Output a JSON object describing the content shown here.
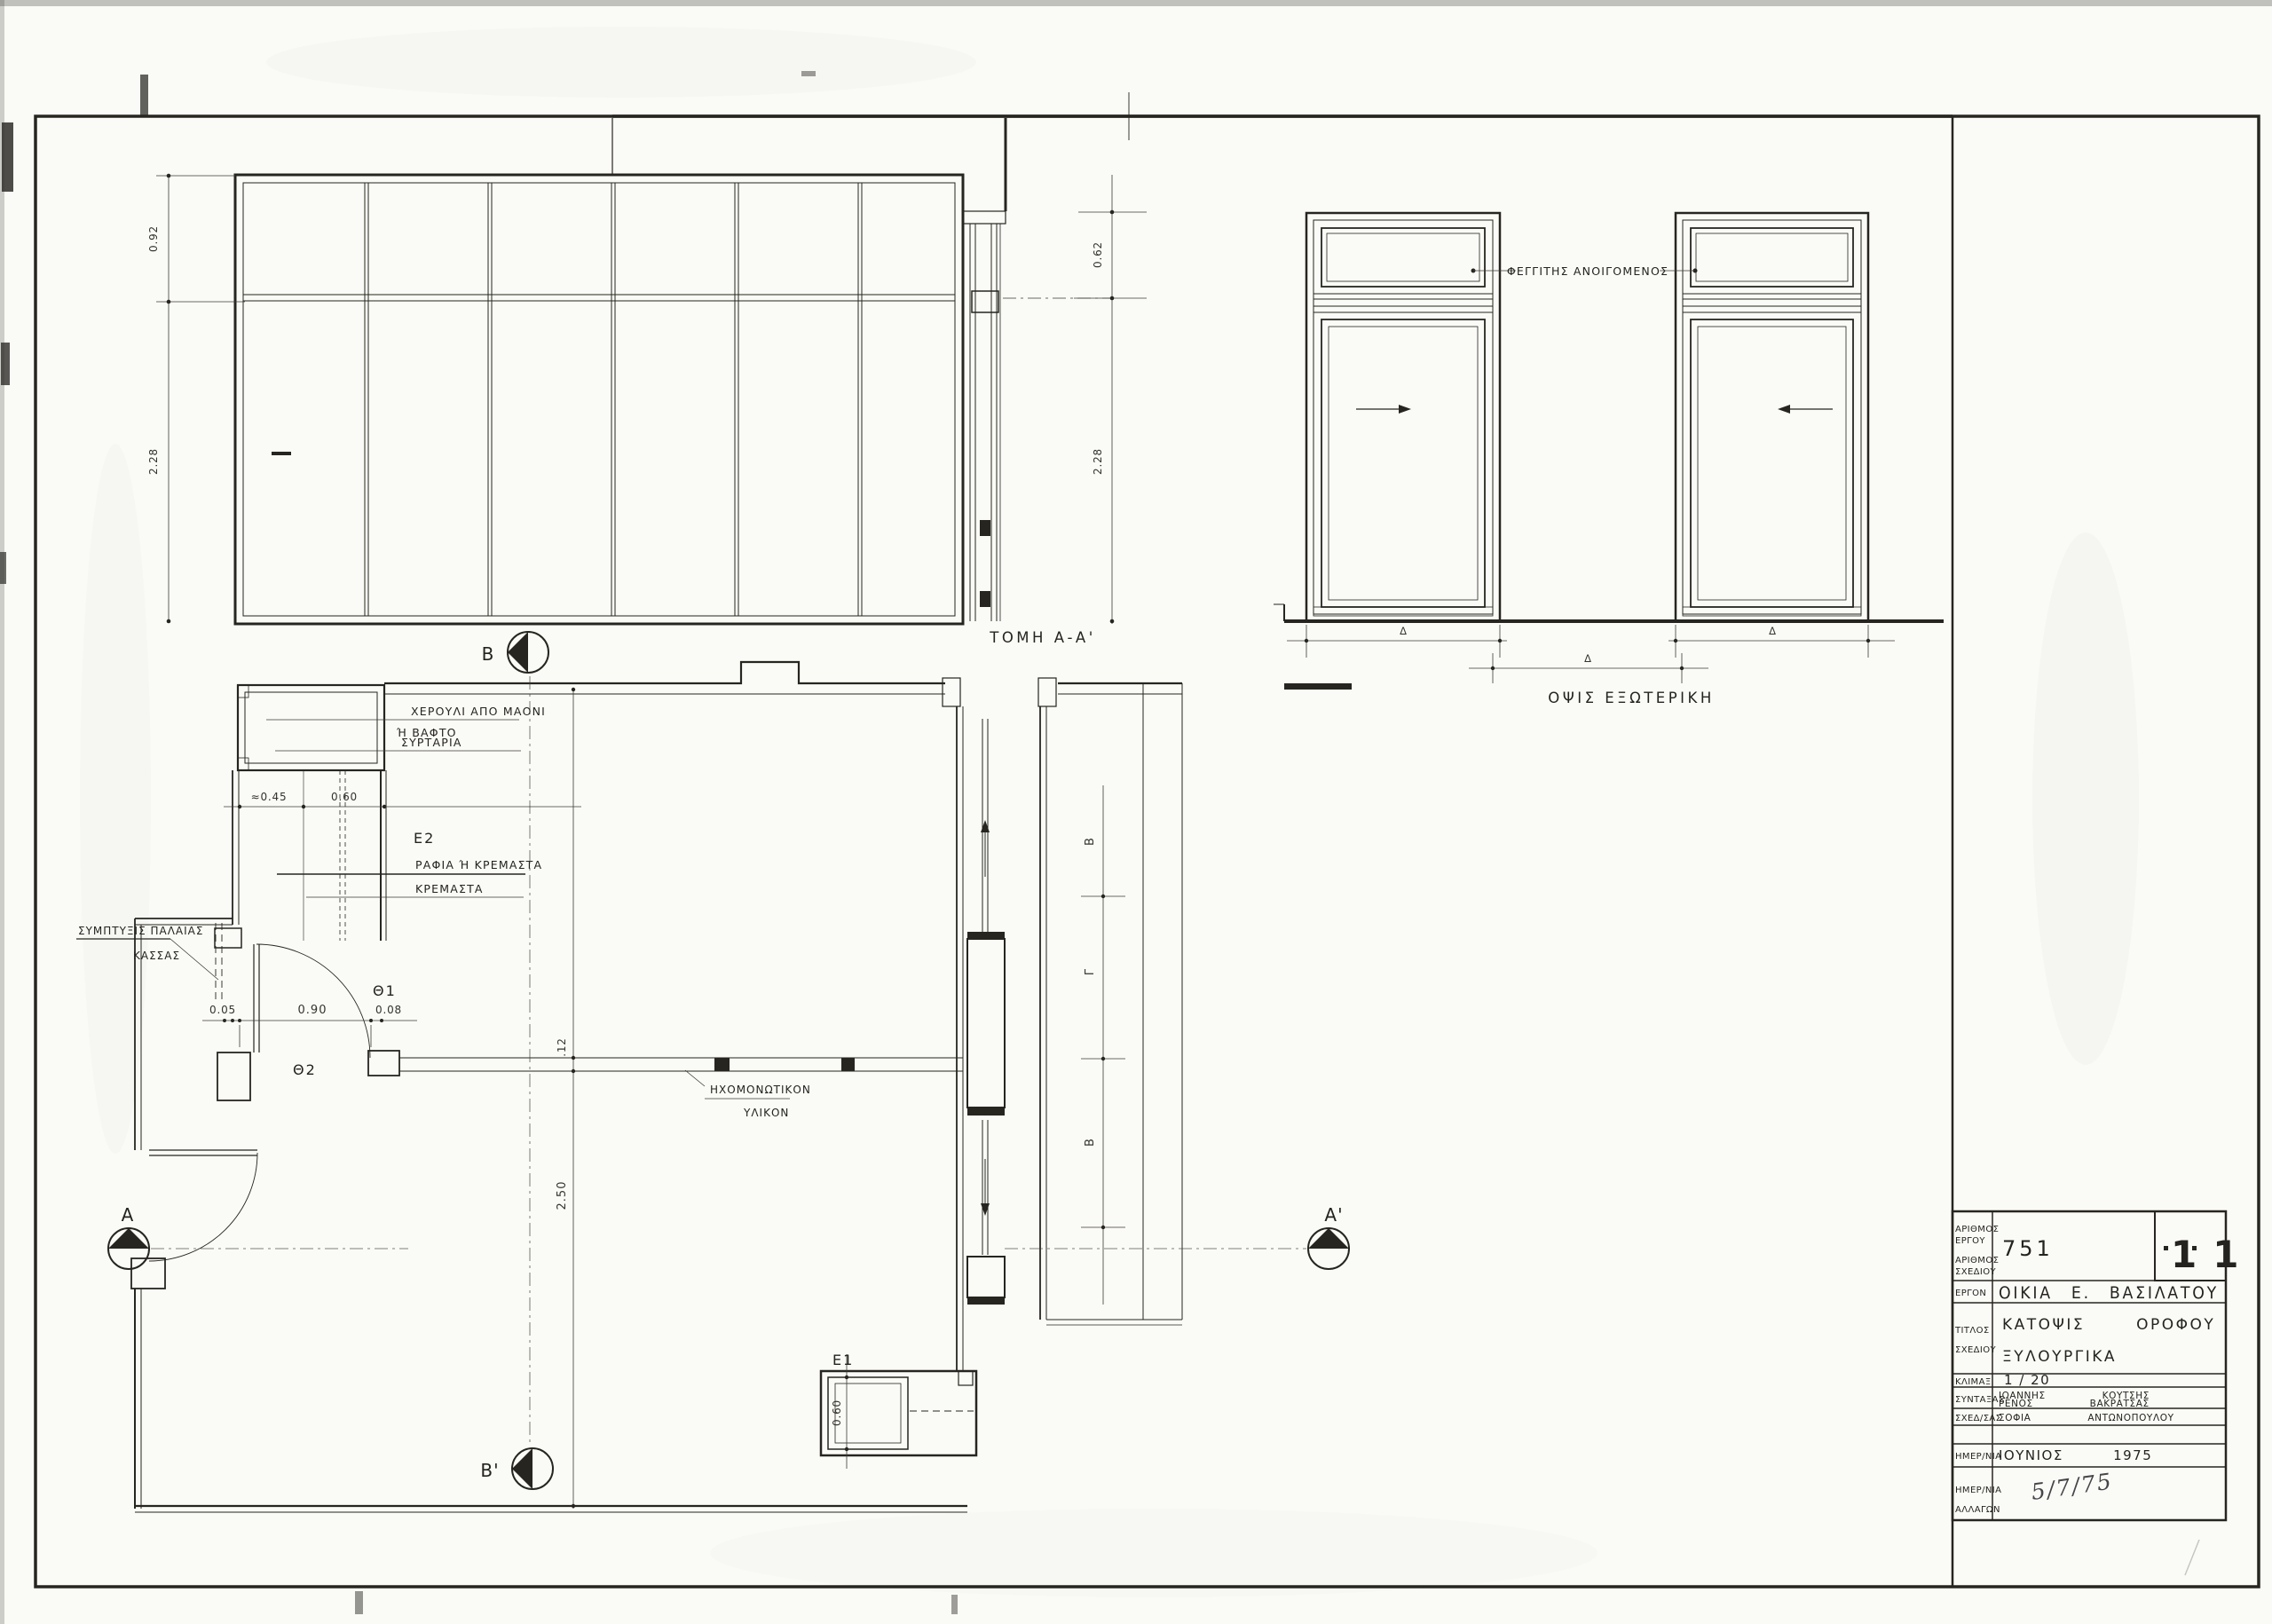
{
  "colors": {
    "paper": "#fafaf6",
    "ink": "#26251f"
  },
  "title_block": {
    "project_number_label_line1": "ΑΡΙΘΜΟΣ",
    "project_number_label_line2": "ΕΡΓΟΥ",
    "drawing_number_label_line1": "ΑΡΙΘΜΟΣ",
    "drawing_number_label_line2": "ΣΧΕΔΙΟΥ",
    "project_number": "751",
    "sheet_number": "11",
    "project_label": "ΕΡΓΟΝ",
    "project_name": "ΟΙΚΙΑ Ε. ΒΑΣΙΛΑΤΟΥ",
    "title_label_line1": "ΤΙΤΛΟΣ",
    "title_label_line2": "ΣΧΕΔΙΟΥ",
    "title_line1": "ΚΑΤΟΨΙΣ ΟΡΟΦΟΥ",
    "title_line2": "ΞΥΛΟΥΡΓΙΚΑ",
    "scale_label": "ΚΛΙΜΑΞ",
    "scale_value": "1 / 20",
    "author_label": "ΣΥΝΤΑΞΑΣ",
    "author1": "ΙΩΑΝΝΗΣ ΚΟΥΤΣΗΣ",
    "author2": "ΡΕΝΟΣ ΒΑΚΡΑΤΣΑΣ",
    "draftsman_label": "ΣΧΕΔ/ΣΑΣ",
    "draftsman": "ΣΟΦΙΑ ΑΝΤΩΝΟΠΟΥΛΟΥ",
    "date_label": "ΗΜΕΡ/ΝΙΑ",
    "date_value": "ΙΟΥΝΙΟΣ 1975",
    "revision_label_line1": "ΗΜΕΡ/ΝΙΑ",
    "revision_label_line2": "ΑΛΛΑΓΩΝ",
    "revision_date": "5/7/75"
  },
  "section": {
    "title": "ΤΟΜΗ Α-Α'",
    "dims": {
      "left_top": "0.92",
      "left_bottom": "2.28",
      "right_top": "0.62",
      "right_bottom": "2.28"
    }
  },
  "elevation": {
    "title": "ΟΨΙΣ ΕΞΩΤΕΡΙΚΗ",
    "transom_note": "ΦΕΓΓΙΤΗΣ ΑΝΟΙΓΟΜΕΝΟΣ",
    "deltas": [
      "Δ",
      "Δ",
      "Δ"
    ]
  },
  "plan": {
    "notes": {
      "handle_line1": "ΧΕΡΟΥΛΙ ΑΠΟ ΜΑΟΝΙ",
      "handle_line2": "Ή ΒΑΦΤΟ",
      "drawers": "ΣΥΡΤΑΡΙΑ",
      "shelves_line1": "ΡΑΦΙΑ Ή ΚΡΕΜΑΣΤΑ",
      "shelves_line2": "ΚΡΕΜΑΣΤΑ",
      "old_frame_line1": "ΣΥΜΠΤΥΞΙΣ ΠΑΛΑΙΑΣ",
      "old_frame_line2": "ΚΑΣΣΑΣ",
      "insulation_line1": "ΗΧΟΜΟΝΩΤΙΚΟΝ",
      "insulation_line2": "ΥΛΙΚΟΝ"
    },
    "labels": {
      "door1": "Θ1",
      "door2": "Θ2",
      "closet1": "Ε1",
      "closet2": "Ε2"
    },
    "dims": {
      "e2_depth": "≈0.45",
      "e2_width": "0.60",
      "gap": "0.05",
      "door_width": "0.90",
      "jamb": "0.08",
      "wall_thickness": ".12",
      "room_depth": "2.50",
      "e1_width": "0.60"
    },
    "markers": {
      "a": "A",
      "a_prime": "A'",
      "b": "B",
      "b_prime": "B'"
    },
    "corridor_dims": [
      "Β",
      "Γ",
      "Β"
    ]
  }
}
